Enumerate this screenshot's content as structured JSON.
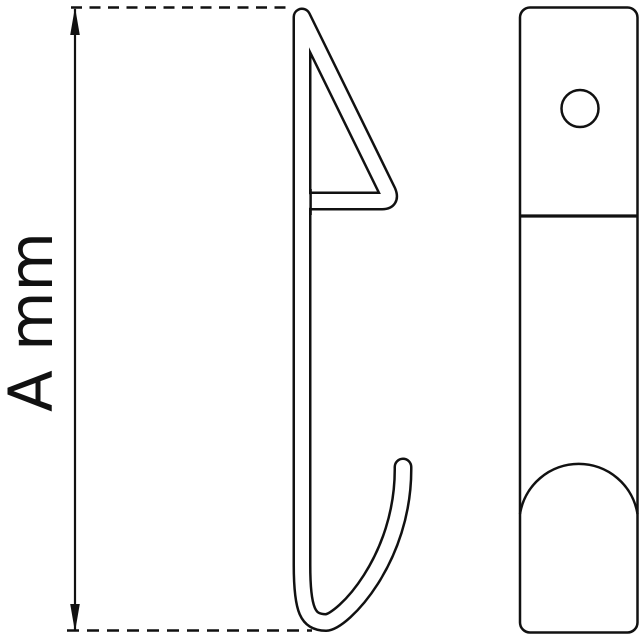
{
  "dimension": {
    "label": "A mm"
  },
  "colors": {
    "line": "#111111",
    "background": "#ffffff"
  }
}
